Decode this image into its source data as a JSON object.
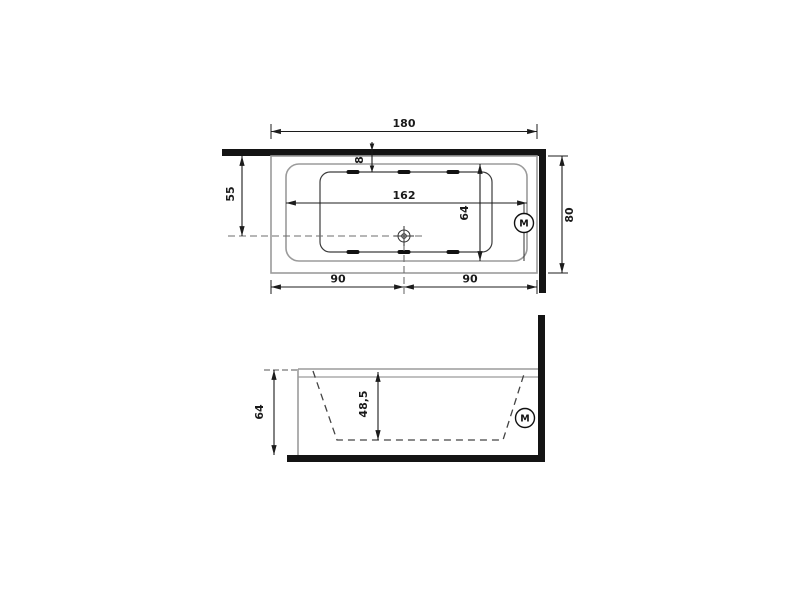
{
  "drawing": {
    "type": "technical-drawing",
    "subject": "built-in rectangular whirlpool bathtub with motor, plan (top) view and section (side) view against two walls",
    "colors": {
      "wall": "#141414",
      "tub_outline": "#9b9b9b",
      "basin_line": "#3d3d3d",
      "dimension": "#1c1c1c",
      "centerline": "#6e6e6e",
      "background": "#ffffff"
    },
    "top_view": {
      "labels": {
        "overall_length": "180",
        "overall_width": "80",
        "rim_length": "162",
        "rim_width": "64",
        "drain_offset_from_wall": "55",
        "rim_to_basin_gap": "8",
        "left_half": "90",
        "right_half": "90",
        "motor": "M"
      }
    },
    "side_view": {
      "labels": {
        "overall_height": "64",
        "basin_depth": "48,5",
        "motor": "M"
      }
    }
  }
}
